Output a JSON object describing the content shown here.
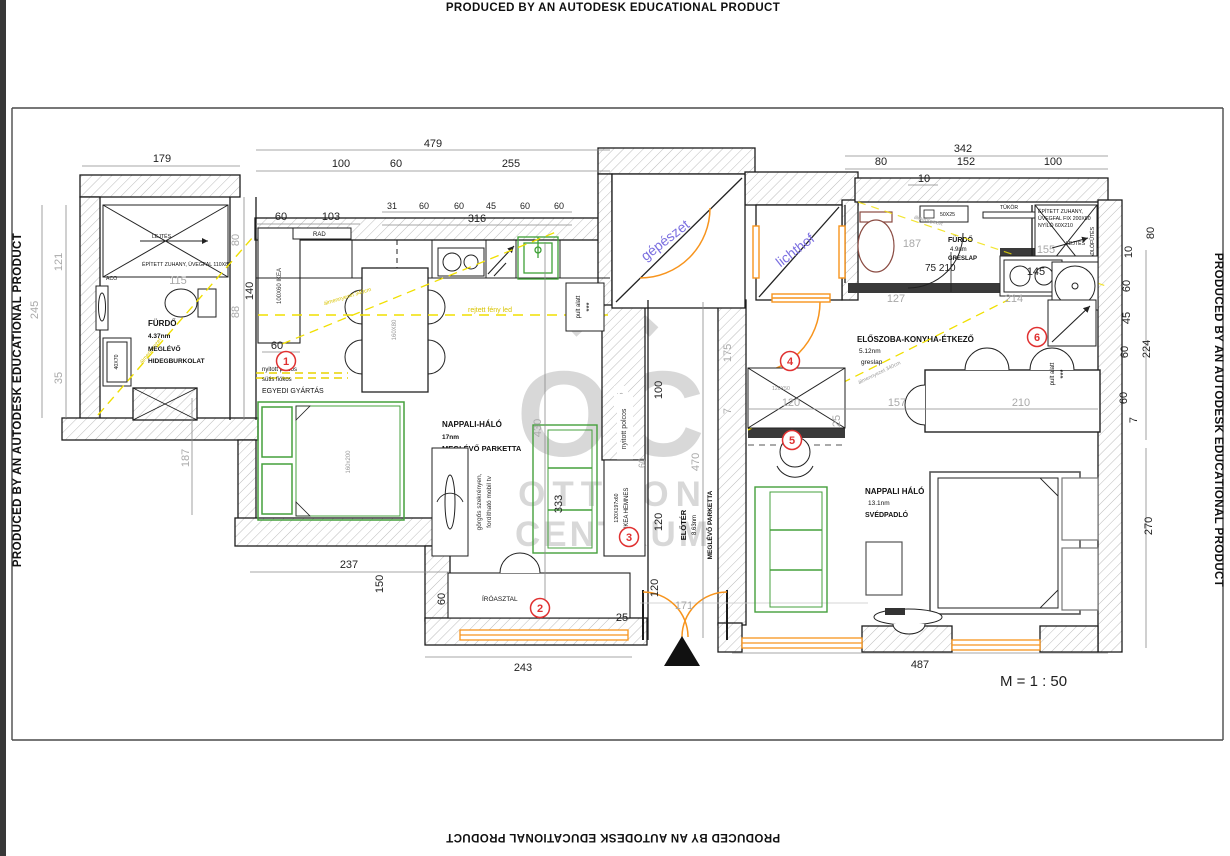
{
  "meta": {
    "producer": "PRODUCED BY AN AUTODESK EDUCATIONAL PRODUCT",
    "scale": "M = 1 : 50"
  },
  "watermark": {
    "monogram": "OC",
    "line1": "OTTHON",
    "line2": "CENTRUM"
  },
  "shaft_labels": {
    "gepeszet": "gépészet",
    "lichthof": "lichthof"
  },
  "rooms": {
    "furdo_left": {
      "name": "FÜRDŐ",
      "area": "4.37nm",
      "floor1": "MEGLÉVŐ",
      "floor2": "HIDEGBURKOLAT"
    },
    "nappali_left": {
      "name": "NAPPALI-HÁLÓ",
      "area": "17nm",
      "floor": "MEGLÉVŐ PARKETTA"
    },
    "eloter": {
      "name": "ELŐTÉR",
      "area": "8.63nm",
      "floor": "MEGLÉVŐ PARKETTA"
    },
    "furdo_right": {
      "name": "FÜRDŐ",
      "area": "4.9nm",
      "floor": "GRESLAP"
    },
    "eloszoba": {
      "name": "ELŐSZOBA-KONYHA-ÉTKEZŐ",
      "area": "5.12nm",
      "floor": "greslap"
    },
    "nappali_right": {
      "name": "NAPPALI HÁLÓ",
      "area": "13.1nm",
      "floor": "SVÉDPADLÓ"
    }
  },
  "annotations": {
    "shower_left": "ÉPÍTETT ZUHANY, ÜVEGFAL 110X80",
    "lejtes": "LEJTÉS",
    "aco": "ACO",
    "tray": "40X70",
    "ikea_cabinet": "100X60 IKEA",
    "cab_line1": "nyitott polcos",
    "cab_line2": "sütis fiókos",
    "cab_line3": "EGYEDI GYÁRTÁS",
    "rad": "RAD",
    "island": "160X80",
    "bed_left": "160x200",
    "tv_line1": "görgős szekrényen,",
    "tv_line2": "fordítható mobil tv",
    "desk": "ÍRÓASZTAL",
    "shelf": "nyitott polcos",
    "hemnes1": "120X197x60",
    "hemnes2": "IKEA HEMNES",
    "ceiling_left": "álmennyezet",
    "ceiling_kitchen": "álmennyezet 340cm",
    "led": "rejtett fény led",
    "pult": "pult alatt",
    "stars": "***",
    "ceiling_right": "álmennyezet 340cm",
    "ceiling_bath": "álmennyezet",
    "mirror": "TÜKÖR",
    "cab_5025": "50X25",
    "shower_right_1": "ÉPÍTETT ZUHANY,",
    "shower_right_2": "ÜVEGFAL FIX 200X80",
    "shower_right_3": "NYÍLÓ 60X210",
    "heating": "PADLÓFŰTÉS",
    "cab_12050": "120X50",
    "door_75": "75 210"
  },
  "markers": [
    "1",
    "2",
    "3",
    "4",
    "5",
    "6"
  ],
  "dims": {
    "top": [
      "479",
      "179",
      "100",
      "60",
      "255",
      "342",
      "80",
      "152",
      "100",
      "10"
    ],
    "kitchen": [
      "60",
      "103",
      "31",
      "60",
      "60",
      "45",
      "60",
      "60",
      "316"
    ],
    "left": [
      "245",
      "121",
      "35",
      "115",
      "80",
      "88",
      "140",
      "60",
      "187"
    ],
    "mid": [
      "430",
      "333",
      "35",
      "60",
      "100",
      "120",
      "470",
      "175",
      "7"
    ],
    "bottom": [
      "237",
      "150",
      "60",
      "243",
      "25",
      "120",
      "171",
      "487"
    ],
    "bath": [
      "187",
      "127",
      "155",
      "214",
      "145"
    ],
    "dining": [
      "120",
      "157",
      "210",
      "25"
    ],
    "right": [
      "80",
      "10",
      "60",
      "45",
      "60",
      "60",
      "7",
      "224",
      "270"
    ]
  }
}
